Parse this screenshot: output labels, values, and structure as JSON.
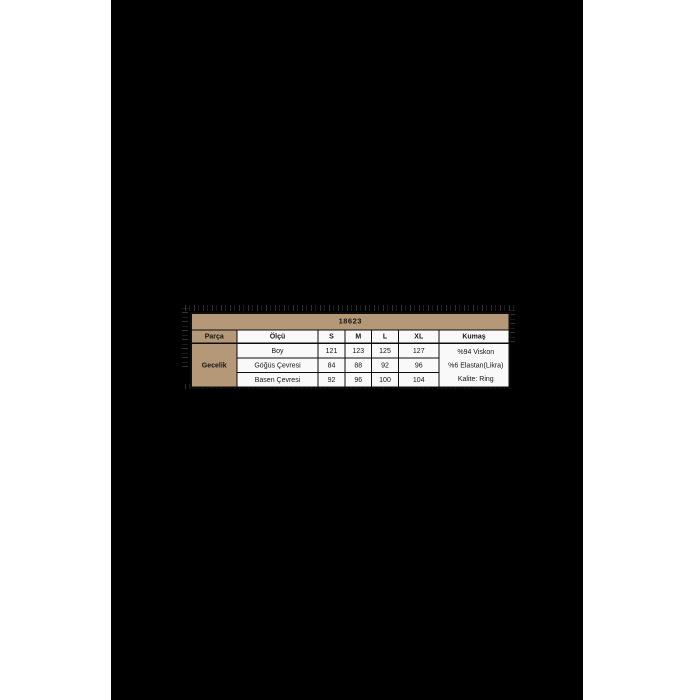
{
  "colors": {
    "page_bg": "#ffffff",
    "image_bg": "#000000",
    "header_fill": "#b49878",
    "cell_fill": "#f9f9f9",
    "border_col": "#0d0d0d",
    "text_col": "#161616"
  },
  "size_chart": {
    "code": "18623",
    "headers": [
      "Parça",
      "Ölçü",
      "S",
      "M",
      "L",
      "XL",
      "Kumaş"
    ],
    "part": "Gecelik",
    "rows": [
      {
        "label": "Boy",
        "values": [
          "121",
          "123",
          "125",
          "127"
        ]
      },
      {
        "label": "Göğüs Çevresi",
        "values": [
          "84",
          "88",
          "92",
          "96"
        ]
      },
      {
        "label": "Basen Çevresi",
        "values": [
          "92",
          "96",
          "100",
          "104"
        ]
      }
    ],
    "fabric": [
      "%94 Viskon",
      "%6 Elastan(Likra)",
      "Kalite: Ring"
    ]
  },
  "chart_data": {
    "type": "table",
    "title": "18623",
    "columns": [
      "Parça",
      "Ölçü",
      "S",
      "M",
      "L",
      "XL",
      "Kumaş"
    ],
    "rows": [
      [
        "Gecelik",
        "Boy",
        "121",
        "123",
        "125",
        "127",
        "%94 Viskon"
      ],
      [
        "Gecelik",
        "Göğüs Çevresi",
        "84",
        "88",
        "92",
        "96",
        "%6 Elastan(Likra)"
      ],
      [
        "Gecelik",
        "Basen Çevresi",
        "92",
        "96",
        "100",
        "104",
        "Kalite: Ring"
      ]
    ],
    "layout_hints": {
      "title_row_spans_all_columns": true,
      "part_column_rowspan": 3,
      "fabric_column_rowspan": 3,
      "header_cells_bold": true,
      "tan_cells": [
        "title",
        "Parça",
        "Gecelik"
      ]
    }
  }
}
